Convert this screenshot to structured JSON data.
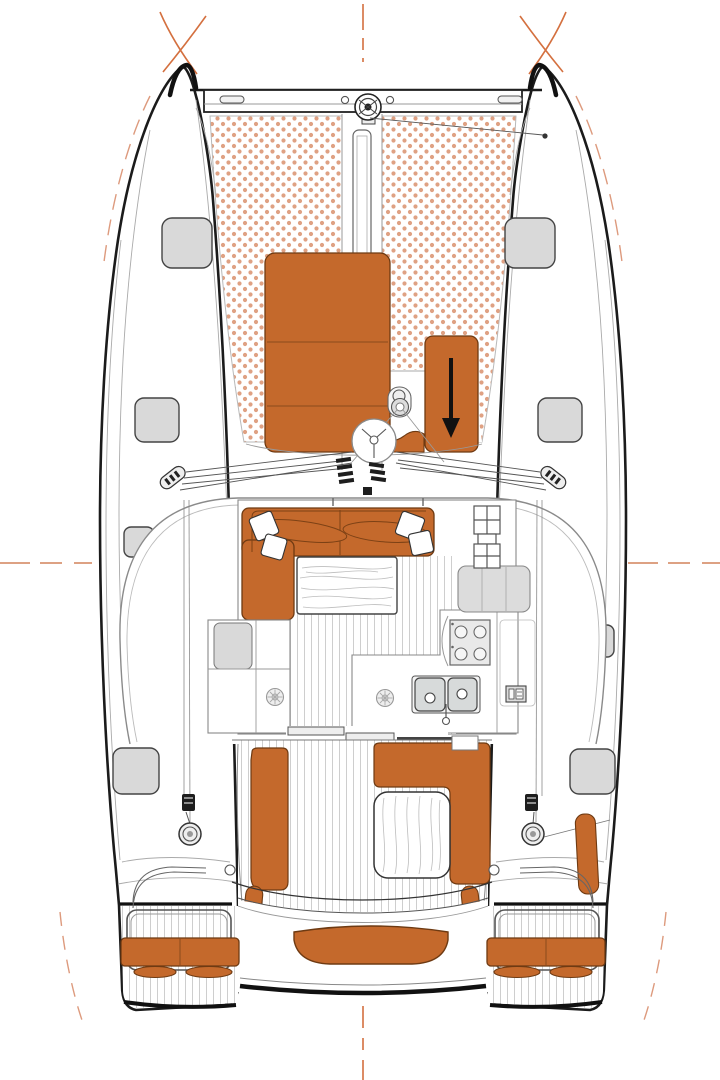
{
  "diagram": {
    "kind": "catamaran-deck-plan-top-view",
    "aria_label": "Top view deck plan of a sailing catamaran with trampoline, bow sun pads, salon with L-shaped sofa and galley, cockpit with benches and table, and twin transom swim platforms",
    "colors": {
      "background": "#ffffff",
      "cushion_orange": "#c4692c",
      "cushion_outline": "#6e3a12",
      "trampoline_dot": "#dfa183",
      "hull_outline": "#1b1b1b",
      "detail_dark": "#555555",
      "detail_light": "#9a9a9a",
      "hatch_fill": "#d9d9d9",
      "counter_gray": "#d9d9d9",
      "guide_orange": "#d4703f",
      "plank_line": "#c9c9c9",
      "arrow_black": "#111111"
    },
    "features": {
      "bow_area": [
        "forward-crossbeam",
        "code-zero-furler",
        "trampoline-net",
        "bowsprit-channel",
        "anchor-windlass",
        "port-sun-pad",
        "starboard-sun-pad-with-arrow"
      ],
      "deck_hatches_port": 4,
      "deck_hatches_starboard": 4,
      "mast_rigging": [
        "mast-base",
        "deck-organizers",
        "port-chainplate",
        "starboard-chainplate",
        "shroud-lines"
      ],
      "salon": [
        "l-shaped-sofa",
        "throw-pillows",
        "salon-table-wood",
        "galley-counter",
        "stove-4-burner",
        "double-sink",
        "tall-cabinet",
        "companionway-steps",
        "deck-plates"
      ],
      "cockpit": [
        "port-bench",
        "starboard-l-bench",
        "cockpit-table-wood",
        "sliding-door-tracks",
        "aft-bench"
      ],
      "stern": [
        "port-swim-platform",
        "starboard-swim-platform",
        "platform-cushions",
        "step-cushions",
        "port-winch",
        "starboard-winch",
        "helm-seat-curves"
      ]
    }
  }
}
